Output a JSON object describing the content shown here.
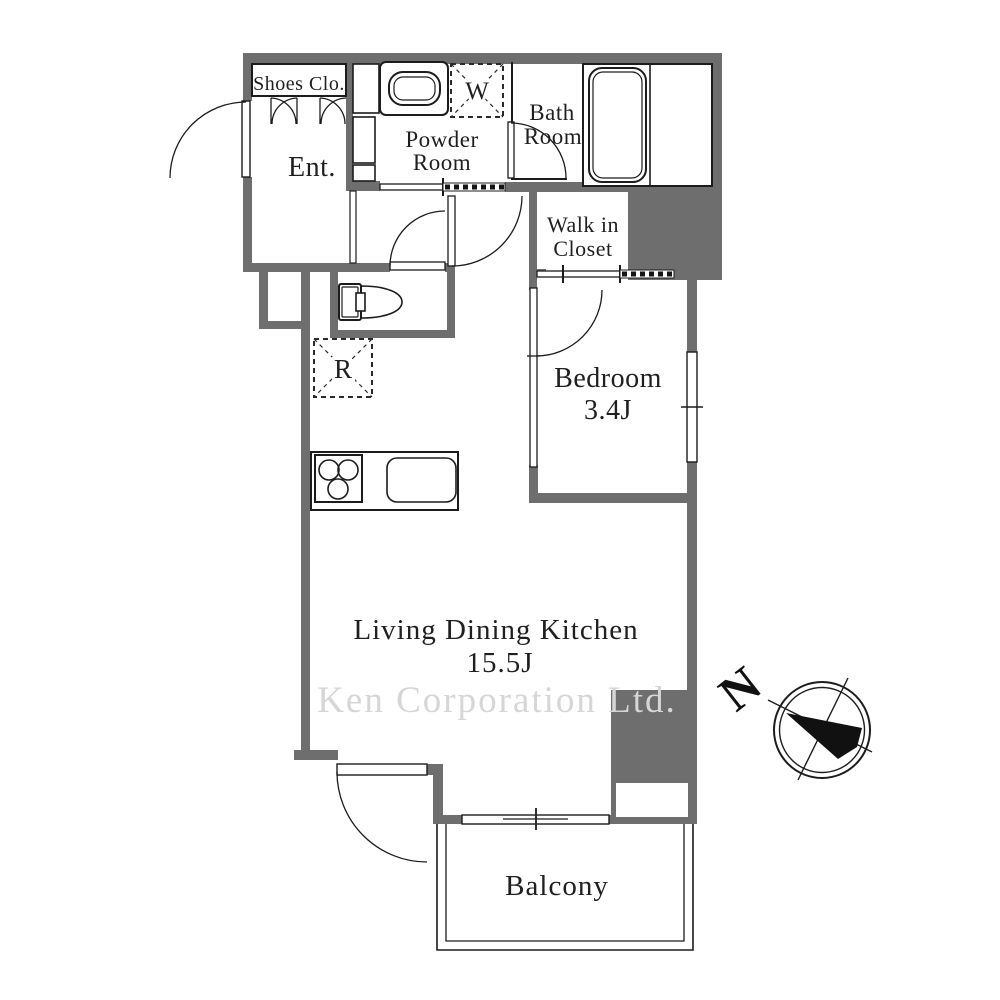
{
  "floor_plan": {
    "rooms": {
      "shoes_closet": {
        "label": "Shoes Clo."
      },
      "entrance": {
        "label": "Ent."
      },
      "powder_room": {
        "line1": "Powder",
        "line2": "Room"
      },
      "bath_room": {
        "line1": "Bath",
        "line2": "Room"
      },
      "walk_in_closet": {
        "line1": "Walk in",
        "line2": "Closet"
      },
      "bedroom": {
        "label": "Bedroom",
        "size": "3.4J"
      },
      "living_dining_kitchen": {
        "label": "Living Dining Kitchen",
        "size": "15.5J"
      },
      "balcony": {
        "label": "Balcony"
      }
    },
    "markers": {
      "washing_machine": "W",
      "refrigerator": "R"
    },
    "compass": {
      "north_label": "N"
    },
    "watermark": {
      "text": "Ken Corporation Ltd."
    },
    "colors": {
      "wall": "#6e6e6e",
      "line": "#1c1c1c",
      "text": "#1f1f1f",
      "watermark": "#d6d6d6",
      "background": "#ffffff"
    }
  }
}
